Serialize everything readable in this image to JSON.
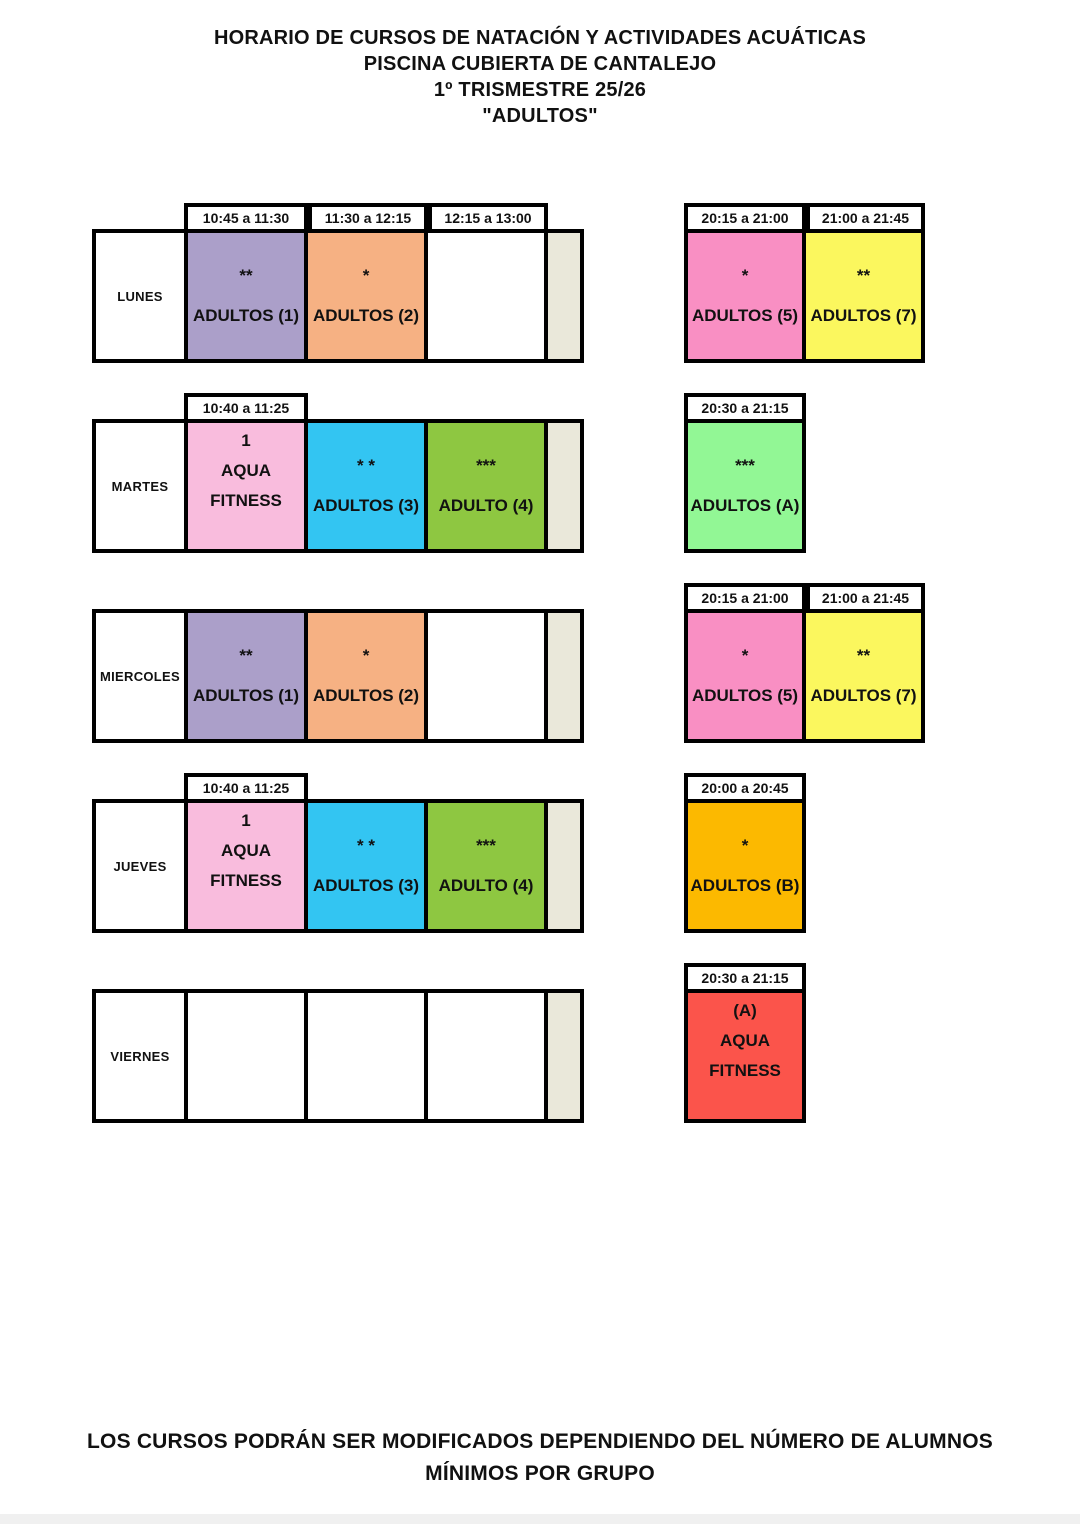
{
  "page": {
    "title_lines": [
      "HORARIO DE CURSOS DE NATACIÓN Y ACTIVIDADES ACUÁTICAS",
      "PISCINA CUBIERTA DE CANTALEJO",
      "1º TRISMESTRE 25/26",
      "\"ADULTOS\""
    ],
    "footer_lines": [
      "LOS CURSOS PODRÁN SER MODIFICADOS DEPENDIENDO DEL NÚMERO DE ALUMNOS",
      "MÍNIMOS POR GRUPO"
    ]
  },
  "colors": {
    "purple": "#ab9fc9",
    "orange": "#f6b183",
    "hot_pink": "#f98fc3",
    "yellow": "#fbf75e",
    "light_pink": "#f9bcdd",
    "blue": "#33c5f2",
    "green": "#8ec741",
    "mint": "#92f795",
    "amber": "#fcb900",
    "red": "#fb544b",
    "beige": "#eae8da",
    "white": "#ffffff",
    "border": "#000000",
    "bottom_strip": "#f0f0f0"
  },
  "schedule": {
    "rows": [
      {
        "day": "LUNES",
        "left": {
          "headers": [
            {
              "col": 0,
              "text": "10:45 a 11:30"
            },
            {
              "col": 1,
              "text": "11:30 a 12:15"
            },
            {
              "col": 2,
              "text": "12:15 a 13:00"
            }
          ],
          "cells": [
            {
              "color": "purple",
              "layout": "mid",
              "lines": [
                "**",
                "ADULTOS (1)"
              ]
            },
            {
              "color": "orange",
              "layout": "mid",
              "lines": [
                "*",
                "ADULTOS (2)"
              ]
            },
            {
              "color": "white",
              "layout": "mid",
              "lines": []
            }
          ]
        },
        "right": {
          "headers": [
            {
              "col": 0,
              "text": "20:15 a 21:00"
            },
            {
              "col": 1,
              "text": "21:00 a 21:45"
            }
          ],
          "cells": [
            {
              "color": "hot_pink",
              "layout": "mid",
              "lines": [
                "*",
                "ADULTOS (5)"
              ]
            },
            {
              "color": "yellow",
              "layout": "mid",
              "lines": [
                "**",
                "ADULTOS (7)"
              ]
            }
          ]
        }
      },
      {
        "day": "MARTES",
        "left": {
          "headers": [
            {
              "col": 0,
              "text": "10:40 a 11:25"
            }
          ],
          "cells": [
            {
              "color": "light_pink",
              "layout": "top",
              "lines": [
                "1",
                "AQUA",
                "FITNESS"
              ]
            },
            {
              "color": "blue",
              "layout": "mid",
              "lines": [
                "* *",
                "ADULTOS (3)"
              ]
            },
            {
              "color": "green",
              "layout": "mid",
              "lines": [
                "***",
                "ADULTO (4)"
              ]
            }
          ]
        },
        "right": {
          "headers": [
            {
              "col": 0,
              "text": "20:30 a 21:15"
            }
          ],
          "cells": [
            {
              "color": "mint",
              "layout": "mid",
              "lines": [
                "***",
                "ADULTOS (A)"
              ]
            }
          ]
        }
      },
      {
        "day": "MIERCOLES",
        "left": {
          "headers": [],
          "cells": [
            {
              "color": "purple",
              "layout": "mid",
              "lines": [
                "**",
                "ADULTOS (1)"
              ]
            },
            {
              "color": "orange",
              "layout": "mid",
              "lines": [
                "*",
                "ADULTOS (2)"
              ]
            },
            {
              "color": "white",
              "layout": "mid",
              "lines": []
            }
          ]
        },
        "right": {
          "headers": [
            {
              "col": 0,
              "text": "20:15 a 21:00"
            },
            {
              "col": 1,
              "text": "21:00 a 21:45"
            }
          ],
          "cells": [
            {
              "color": "hot_pink",
              "layout": "mid",
              "lines": [
                "*",
                "ADULTOS (5)"
              ]
            },
            {
              "color": "yellow",
              "layout": "mid",
              "lines": [
                "**",
                "ADULTOS (7)"
              ]
            }
          ]
        }
      },
      {
        "day": "JUEVES",
        "left": {
          "headers": [
            {
              "col": 0,
              "text": "10:40 a 11:25"
            }
          ],
          "cells": [
            {
              "color": "light_pink",
              "layout": "top",
              "lines": [
                "1",
                "AQUA",
                "FITNESS"
              ]
            },
            {
              "color": "blue",
              "layout": "mid",
              "lines": [
                "* *",
                "ADULTOS (3)"
              ]
            },
            {
              "color": "green",
              "layout": "mid",
              "lines": [
                "***",
                "ADULTO (4)"
              ]
            }
          ]
        },
        "right": {
          "headers": [
            {
              "col": 0,
              "text": "20:00 a 20:45"
            }
          ],
          "cells": [
            {
              "color": "amber",
              "layout": "mid",
              "lines": [
                "*",
                "ADULTOS (B)"
              ]
            }
          ]
        }
      },
      {
        "day": "VIERNES",
        "left": {
          "headers": [],
          "cells": [
            {
              "color": "white",
              "layout": "mid",
              "lines": []
            },
            {
              "color": "white",
              "layout": "mid",
              "lines": []
            },
            {
              "color": "white",
              "layout": "mid",
              "lines": []
            }
          ]
        },
        "right": {
          "headers": [
            {
              "col": 0,
              "text": "20:30 a 21:15"
            }
          ],
          "cells": [
            {
              "color": "red",
              "layout": "top",
              "lines": [
                "(A)",
                "AQUA",
                "FITNESS"
              ]
            }
          ]
        }
      }
    ]
  }
}
